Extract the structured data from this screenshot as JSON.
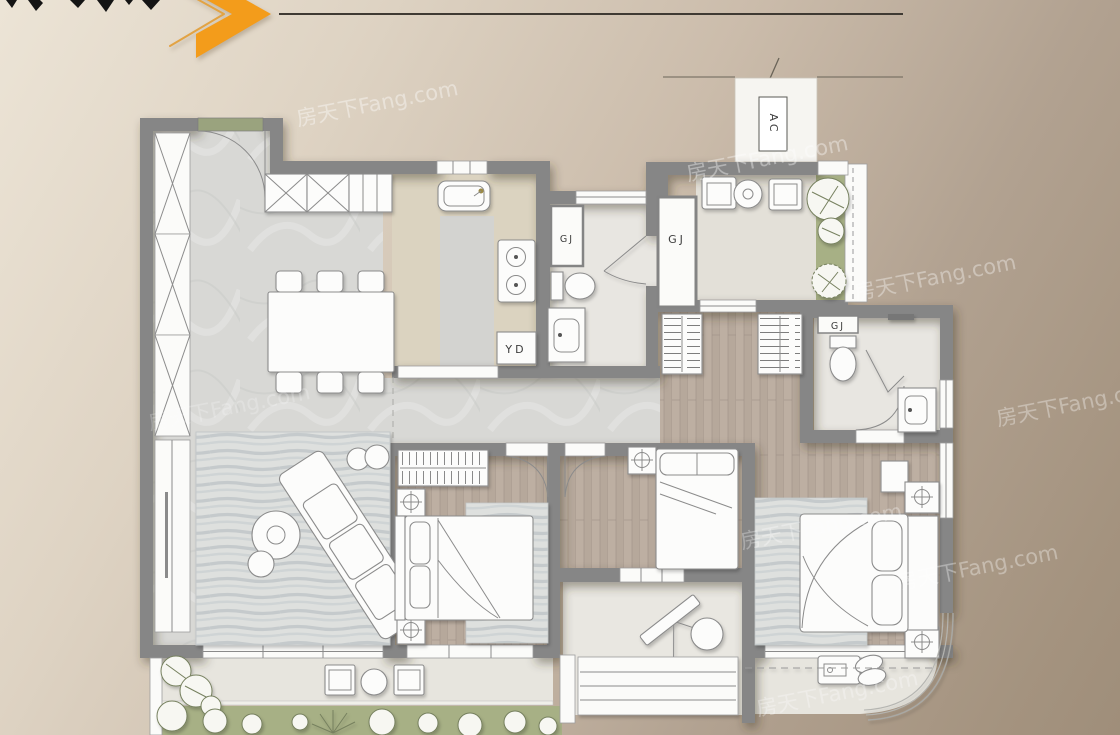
{
  "watermark": {
    "text": "房天下Fang.com"
  },
  "decor": {
    "accent_color": "#f39c1b",
    "line_color": "#3f3a33"
  },
  "plan_labels": {
    "ac": "AC",
    "gj_bath": "GJ",
    "gj_shaft": "GJ",
    "gj_master_bath": "GJ",
    "yd": "YD"
  }
}
